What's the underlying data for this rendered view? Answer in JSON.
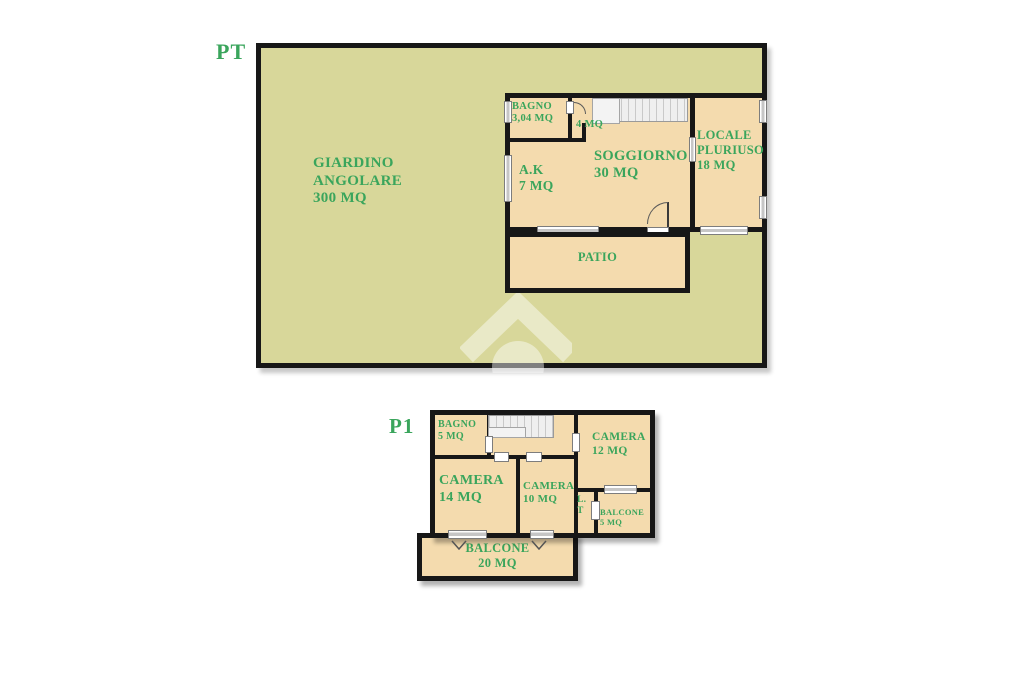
{
  "colors": {
    "wall": "#171717",
    "garden": "#d8d79a",
    "room": "#f4dbae",
    "accent": "#3aa55c",
    "stairs": "#efefef"
  },
  "pt": {
    "floor_label": "PT",
    "garden": {
      "line1": "GIARDINO",
      "line2": "ANGOLARE",
      "area": "300 MQ"
    },
    "bagno": {
      "name": "BAGNO",
      "area": "3,04 MQ"
    },
    "disimpegno": {
      "area": "4 MQ"
    },
    "soggiorno": {
      "name": "SOGGIORNO",
      "area": "30 MQ"
    },
    "locale": {
      "line1": "LOCALE",
      "line2": "PLURIUSO",
      "area": "18 MQ"
    },
    "angolo_cottura": {
      "name": "A.K",
      "area": "7 MQ"
    },
    "patio": {
      "name": "PATIO"
    }
  },
  "p1": {
    "floor_label": "P1",
    "bagno": {
      "name": "BAGNO",
      "area": "5 MQ"
    },
    "camera12": {
      "name": "CAMERA",
      "area": "12 MQ"
    },
    "camera14": {
      "name": "CAMERA",
      "area": "14 MQ"
    },
    "camera10": {
      "name": "CAMERA",
      "area": "10 MQ"
    },
    "lavanderia": {
      "line1": "L.",
      "line2": "T"
    },
    "balcone5": {
      "name": "BALCONE",
      "area": "5 MQ"
    },
    "balcone20": {
      "name": "BALCONE",
      "area": "20 MQ"
    }
  }
}
